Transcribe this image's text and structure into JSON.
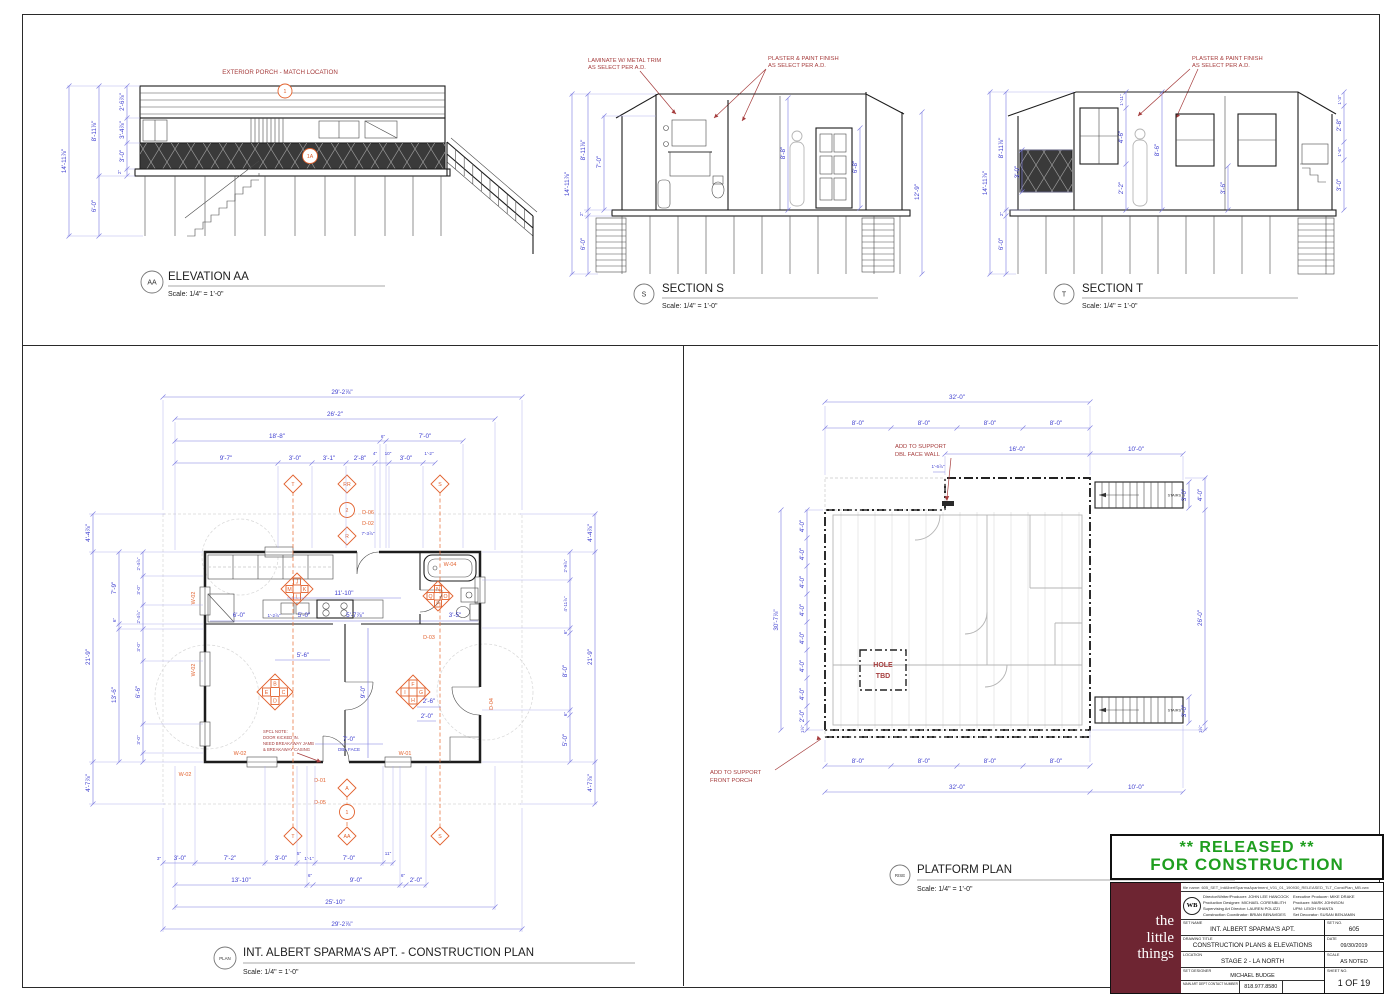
{
  "colors": {
    "released_green": "#1f9e1f",
    "logo_maroon": "#6e2532",
    "dim_blue": "#4040d0",
    "tag_orange": "#e2622e",
    "note_red": "#a63d3d"
  },
  "elev": {
    "tag": "AA",
    "title": "ELEVATION AA",
    "scale": "Scale: 1/4\" = 1'-0\"",
    "note": "EXTERIOR PORCH - MATCH LOCATION",
    "m1": "1",
    "m1a": "1A",
    "d": {
      "h": "14'-11⅞\"",
      "u": "8'-11⅞\"",
      "f": "2'-6⅞\"",
      "w": "3'-4⅞\"",
      "r": "3'-0\"",
      "k": "2\"",
      "s": "6'-0\""
    }
  },
  "secs": {
    "tag": "S",
    "title": "SECTION S",
    "scale": "Scale: 1/4\" = 1'-0\"",
    "n1a": "LAMINATE W/ METAL TRIM",
    "n1b": "AS SELECT PER A.D.",
    "n2a": "PLASTER & PAINT FINISH",
    "n2b": "AS SELECT PER A.D.",
    "d": {
      "h": "14'-11⅞\"",
      "u": "8'-11⅞\"",
      "c": "7'-0\"",
      "k": "2\"",
      "s": "6'-0\"",
      "m": "8'-8\"",
      "dr": "6'-8\"",
      "r": "12'-9\""
    }
  },
  "sect": {
    "tag": "T",
    "title": "SECTION T",
    "scale": "Scale: 1/4\" = 1'-0\"",
    "n1a": "PLASTER & PAINT FINISH",
    "n1b": "AS SELECT PER A.D.",
    "d": {
      "h": "14'-11⅞\"",
      "u": "8'-11⅞\"",
      "rl": "3'-0\"",
      "k": "2\"",
      "s": "6'-0\"",
      "rg": "1'-11\"",
      "w1": "4'-6\"",
      "w2": "2'-2\"",
      "i": "8'-6\"",
      "w3": "3'-6\"",
      "r1": "1'-3\"",
      "r2": "2'-8\"",
      "r3": "1'-6\"",
      "r4": "3'-0\""
    }
  },
  "cplan": {
    "tag": "PLAN",
    "title": "INT. ALBERT SPARMA'S APT. - CONSTRUCTION PLAN",
    "scale": "Scale: 1/4\" = 1'-0\"",
    "note": [
      "SPCL NOTE:",
      "DOOR KICKED IN.",
      "NEED BREAKAWAY JAMB",
      "& BREAKAWAY CASING"
    ],
    "dblface": "DBL FACE",
    "tags": {
      "w01": "W-01",
      "w02": "W-02",
      "w04": "W-04",
      "d01": "D-01",
      "d02": "D-02",
      "d03": "D-03",
      "d04": "D-04",
      "d05": "D-05",
      "d06": "D-06"
    },
    "cl": {
      "k": [
        "J",
        "M",
        "K",
        "L"
      ],
      "b": [
        "N",
        "Q",
        "O",
        "P"
      ],
      "l": [
        "B",
        "E",
        "C",
        "D"
      ],
      "r": [
        "F",
        "I",
        "G",
        "H"
      ]
    },
    "mk": {
      "t": "T",
      "rr": "RR",
      "two": "2",
      "r": "R",
      "s": "S",
      "a": "A",
      "one": "1",
      "aa": "AA"
    },
    "dt": {
      "a": "29'-2⅞\"",
      "b": "26'-2\"",
      "c": "18'-8\"",
      "d": "6\"",
      "e": "7'-0\"",
      "f": "9'-7\"",
      "g": "3'-0\"",
      "h": "3'-1\"",
      "i": "2'-8\"",
      "j": "4\"",
      "k": "10\"",
      "l": "3'-0\"",
      "m": "1'-2\""
    },
    "db": {
      "a": "3\"",
      "b": "3'-0\"",
      "c": "7'-2\"",
      "d": "3'-0\"",
      "e": "5\"",
      "f": "1'-1\"",
      "g": "7'-0\"",
      "h": "11\"",
      "i": "13'-10\"",
      "j": "6\"",
      "k": "9'-0\"",
      "l": "6\"",
      "m": "2'-0\"",
      "n": "25'-10\"",
      "o": "29'-2⅞\""
    },
    "dl": {
      "a": "4'-4⅞\"",
      "b": "21'-9\"",
      "c": "4'-7⅞\"",
      "d": "7'-9\"",
      "e": "6\"",
      "f": "13'-6\"",
      "g": "2'-4⅞\"",
      "h": "3'-0\"",
      "i": "2'-4⅞\"",
      "j": "3'-0\"",
      "k": "6'-6\"",
      "l": "3'-0\""
    },
    "dr2": {
      "a": "4'-4⅞\"",
      "b": "2'-9⅞\"",
      "c": "4'-11⅞\"",
      "d": "6\"",
      "e": "8'-0\"",
      "f": "6\"",
      "g": "5'-0\"",
      "h": "21'-9\"",
      "i": "4'-7⅞\""
    },
    "di": {
      "a": "11'-10\"",
      "b": "7'-3⅞\"",
      "c": "6'-0\"",
      "d": "1'-2⅞\"",
      "e": "5'-0\"",
      "f": "5'-7⅞\"",
      "g": "3'-5\"",
      "h": "5'-6\"",
      "i": "9'-0\"",
      "j": "2'-6\"",
      "k": "2'-0\"",
      "l": "7'-0\""
    }
  },
  "pplan": {
    "tag": "RISE",
    "title": "PLATFORM PLAN",
    "scale": "Scale: 1/4\" = 1'-0\"",
    "n1a": "ADD TO SUPPORT",
    "n1b": "DBL FACE WALL",
    "n2a": "ADD TO SUPPORT",
    "n2b": "FRONT PORCH",
    "hole1": "HOLE",
    "hole2": "TBD",
    "stairs": "STAIRS",
    "d": {
      "w32": "32'-0\"",
      "w8": "8'-0\"",
      "w16": "16'-0\"",
      "w10": "10'-0\"",
      "h30": "30'-7⅞\"",
      "h4": "4'-0\"",
      "h2": "2'-0\"",
      "h26": "26'-0\"",
      "s3": "3'-0\"",
      "off": "1'-6⅞\"",
      "sm": "1½\""
    }
  },
  "tb": {
    "rel1": "**  RELEASED  **",
    "rel2": "FOR CONSTRUCTION",
    "logo1": "the",
    "logo2": "little",
    "logo3": "things",
    "wb": "WB",
    "filename": "file name: 605_SET_IntAlbertSparmaApartment_V01_01_190930_RELEASED_TLT_ConstPlan_MB.vwx",
    "cl1": "Director/Writer/Producer: JOHN LEE HANCOCK",
    "cl2": "Production Designer: MICHAEL CORENBLITH",
    "cl3": "Supervising Art Director: LAUREN POLIZZI",
    "cl4": "Construction Coordinator: BRIAN BENAVIDES",
    "cr1": "Executive Producer: MIKE DRAKE",
    "cr2": "Producer: MARK JOHNSON",
    "cr3": "UPM: LEIGH SHANTA",
    "cr4": "Set Decorator: SUSAN BENJAMIN",
    "l_setname": "SET NAME",
    "v_setname": "INT. ALBERT SPARMA'S APT.",
    "l_setno": "SET NO.",
    "v_setno": "605",
    "l_dtitle": "DRAWING TITLE",
    "v_dtitle": "CONSTRUCTION PLANS & ELEVATIONS",
    "l_date": "DATE",
    "v_date": "09/30/2019",
    "l_loc": "LOCATION",
    "v_loc": "STAGE 2 - LA NORTH",
    "l_scale": "SCALE",
    "v_scale": "AS NOTED",
    "l_designer": "SET DESIGNER",
    "v_designer": "MICHAEL BUDGE",
    "l_sheet": "SHEET NO.",
    "v_sheet": "1 OF 19",
    "l_contact": "MAIN ART DEPT CONTACT NUMBER",
    "v_contact": "818.977.8580"
  }
}
